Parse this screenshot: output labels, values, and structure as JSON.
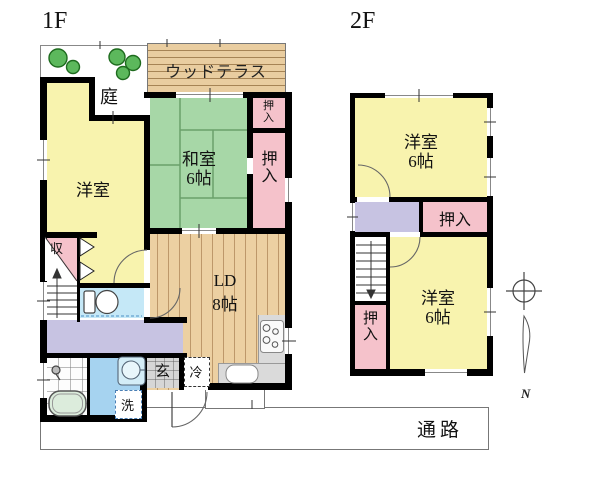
{
  "floor1": {
    "label": "1F",
    "garden": "庭",
    "terrace": "ウッドテラス",
    "western_room": "洋室",
    "japanese_room": "和室",
    "japanese_room_size": "6帖",
    "closet_upper": "押入",
    "closet_lower": "押入",
    "storage": "収",
    "living_dining": "LD",
    "living_dining_size": "8帖",
    "entrance": "玄",
    "fridge": "冷",
    "laundry": "洗"
  },
  "floor2": {
    "label": "2F",
    "room_north": "洋室",
    "room_north_size": "6帖",
    "closet_north": "押入",
    "room_south": "洋室",
    "room_south_size": "6帖",
    "closet_south": "押入"
  },
  "site": {
    "passage": "通路",
    "north_mark": "N"
  },
  "colors": {
    "room_yellow": "#f8f3ae",
    "tatami_green": "#a7d7a7",
    "tatami_line": "#6aa06a",
    "closet_pink": "#f5c2cb",
    "wood_floor": "#ecd0a2",
    "terrace_wood": "#e9cda0",
    "corridor_purple": "#c7c3e2",
    "toilet_blue": "#c5e8f7",
    "washroom_blue": "#a6d3f0",
    "bathtub_green": "#dcecdc",
    "entrance_gray": "#d6d6d6",
    "wall_black": "#000000",
    "tree_green": "#5cb85c"
  }
}
